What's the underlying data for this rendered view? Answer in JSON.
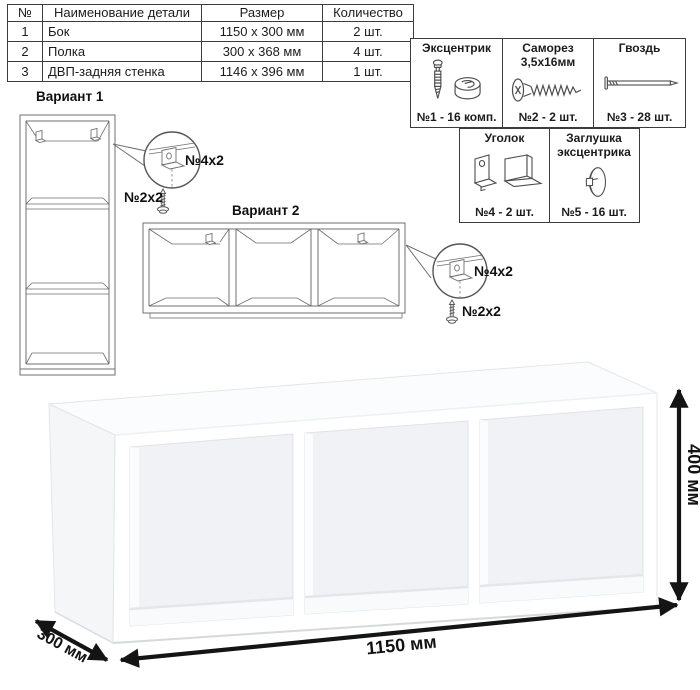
{
  "parts_table": {
    "headers": {
      "num": "№",
      "name": "Наименование детали",
      "size": "Размер",
      "qty": "Количество"
    },
    "rows": [
      {
        "num": "1",
        "name": "Бок",
        "size": "1150 x 300 мм",
        "qty": "2 шт."
      },
      {
        "num": "2",
        "name": "Полка",
        "size": "300 x 368 мм",
        "qty": "4 шт."
      },
      {
        "num": "3",
        "name": "ДВП-задняя стенка",
        "size": "1146 x 396 мм",
        "qty": "1 шт."
      }
    ]
  },
  "hardware": {
    "items": [
      {
        "title": "Эксцентрик",
        "count": "№1 - 16 комп.",
        "icon": "cam-lock-icon"
      },
      {
        "title": "Саморез 3,5х16мм",
        "count": "№2 - 2 шт.",
        "icon": "screw-icon"
      },
      {
        "title": "Гвоздь",
        "count": "№3 - 28 шт.",
        "icon": "nail-icon"
      },
      {
        "title": "Уголок",
        "count": "№4 - 2 шт.",
        "icon": "corner-bracket-icon"
      },
      {
        "title": "Заглушка эксцентрика",
        "count": "№5 - 16 шт.",
        "icon": "cam-cap-icon"
      }
    ]
  },
  "variants": {
    "v1": {
      "title": "Вариант 1"
    },
    "v2": {
      "title": "Вариант 2"
    }
  },
  "callouts": {
    "v1": {
      "bracket": "№4х2",
      "screw": "№2х2"
    },
    "v2": {
      "bracket": "№4х2",
      "screw": "№2х2"
    }
  },
  "dimensions": {
    "width": "1150 мм",
    "depth": "300 мм",
    "height": "400 мм"
  },
  "colors": {
    "table_border": "#3c3c3c",
    "drawing_line": "#6f6f6f",
    "dimension_arrow": "#141414",
    "render_shade": "#f0f2f5",
    "background": "#ffffff"
  }
}
